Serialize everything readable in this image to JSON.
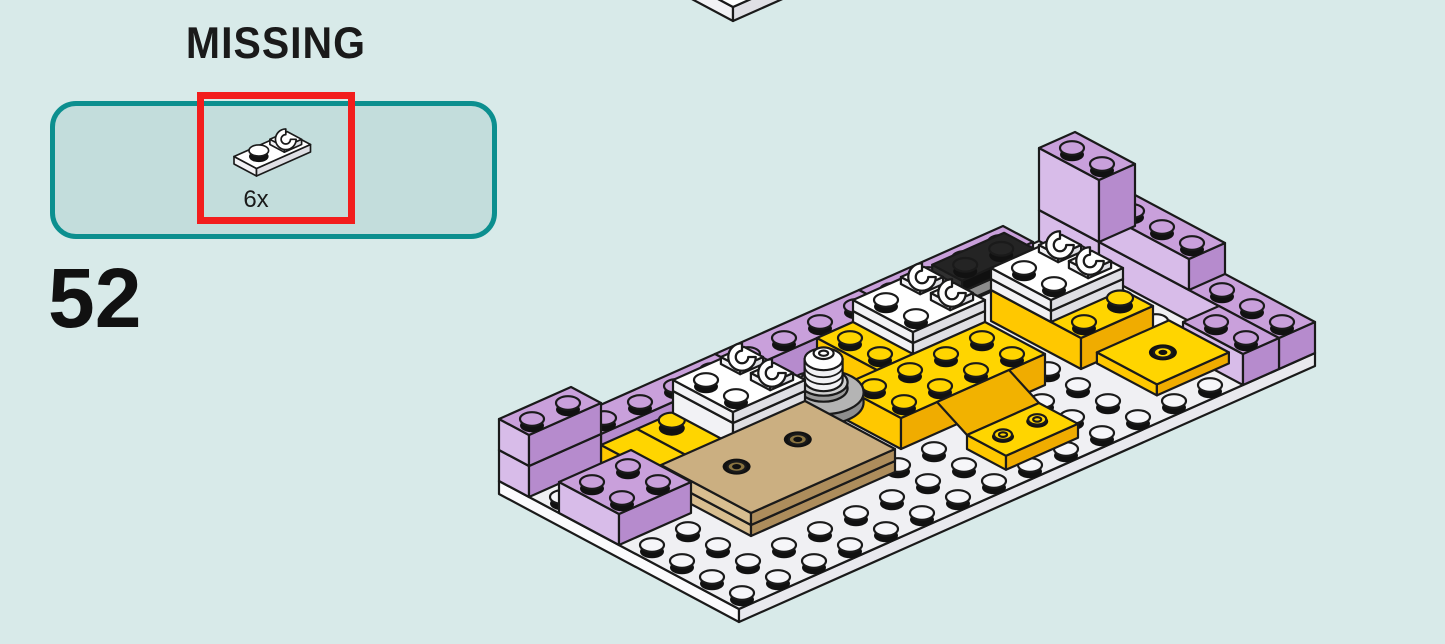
{
  "page": {
    "background": "#D8EAE9"
  },
  "missing_callout": {
    "title": "MISSING",
    "quantity_label": "6x",
    "part": "white 1x2 plate with open clip",
    "panel_color": "#C3DDDC",
    "panel_border_color": "#0C8F8F",
    "highlight_color": "#F21D1D"
  },
  "step": {
    "number": "52"
  },
  "illustration": {
    "description": "Isometric LEGO sub-assembly: white 8x16 baseplate edged with lavender bricks; three white clip-plate pairs on yellow/white stacks; yellow 2x4 brick, slope and inverted tray; yellow 2x2 tile with hole; tan 3x4 plate with two recessed holes; gray turntable with white round brick",
    "colors": {
      "outline": "#1A1A1A",
      "purple": [
        "#C9A0DB",
        "#D8BCE9",
        "#B68BCD"
      ],
      "yellow": [
        "#FFD500",
        "#FFC800",
        "#F0AC00"
      ],
      "white": [
        "#FFFFFF",
        "#F2F2F5",
        "#DFDFE4"
      ],
      "base": [
        "#F0F0F3",
        "#FBFBFD",
        "#E9E9EE"
      ],
      "tan": [
        "#CBAF81",
        "#D8BE90",
        "#AD8D5C"
      ],
      "grayd": [
        "#A6A6A6",
        "#B5B5B5",
        "#8C8C8C"
      ],
      "black": [
        "#242424",
        "#303030",
        "#101010"
      ],
      "gridstud": "#F6F6F9"
    },
    "scenes": [
      {
        "name": "partial-assembly",
        "ox": 745,
        "oy": -43,
        "s": 1,
        "pieces": [
          {
            "t": "box",
            "c": "purple",
            "x": 0,
            "y": 0,
            "w": 2,
            "d": 2,
            "z": 14,
            "h": 60,
            "st": 0
          },
          {
            "t": "box",
            "c": "white",
            "x": 0,
            "y": 0,
            "w": 2,
            "d": 2,
            "z": 0,
            "h": 14,
            "st": 0
          }
        ]
      },
      {
        "name": "main-assembly",
        "ox": 1075,
        "oy": 225,
        "s": 1,
        "pieces": [
          {
            "t": "box",
            "c": "base",
            "x": 0,
            "y": 0,
            "w": 8,
            "d": 16,
            "z": -13,
            "h": 13,
            "st": 0,
            "base": 1
          },
          {
            "t": "grid",
            "cols": 8,
            "rows": 16
          },
          {
            "t": "box",
            "c": "purple",
            "x": 0,
            "y": 0,
            "w": 2,
            "d": 1,
            "z": 0,
            "h": 31
          },
          {
            "t": "box",
            "c": "purple",
            "x": 2,
            "y": 0,
            "w": 6,
            "d": 1,
            "z": 0,
            "h": 31
          },
          {
            "t": "box",
            "c": "purple",
            "x": 2,
            "y": 0,
            "w": 3,
            "d": 1,
            "z": 31,
            "h": 31
          },
          {
            "t": "box",
            "c": "purple",
            "x": 0,
            "y": 0,
            "w": 2,
            "d": 1,
            "z": 31,
            "h": 62
          },
          {
            "t": "box",
            "c": "purple",
            "x": 6,
            "y": 1,
            "w": 2,
            "d": 1,
            "z": 0,
            "h": 31
          },
          {
            "t": "box",
            "c": "purple",
            "x": 0,
            "y": 2,
            "w": 1,
            "d": 4,
            "z": 0,
            "h": 31
          },
          {
            "t": "box",
            "c": "grayd",
            "x": 1,
            "y": 2.8,
            "w": 1,
            "d": 3,
            "z": 31,
            "h": 11
          },
          {
            "t": "box",
            "c": "black",
            "x": 1,
            "y": 2.8,
            "w": 1,
            "d": 2,
            "z": 42,
            "h": 11
          },
          {
            "t": "box",
            "c": "yellow",
            "x": 2,
            "y": 2,
            "w": 3,
            "d": 2,
            "z": 0,
            "h": 31
          },
          {
            "t": "box",
            "c": "white",
            "x": 2,
            "y": 2,
            "w": 2,
            "d": 2,
            "z": 31,
            "h": 11
          },
          {
            "t": "box",
            "c": "white",
            "x": 2,
            "y": 2,
            "w": 2,
            "d": 2,
            "z": 42,
            "h": 11
          },
          {
            "t": "round",
            "c": "yellow",
            "x": 4.5,
            "y": 2.5,
            "z": 31
          },
          {
            "t": "clip",
            "x": 2.5,
            "y": 2.5,
            "z": 53
          },
          {
            "t": "clip",
            "x": 3.5,
            "y": 2.5,
            "z": 53
          },
          {
            "t": "box",
            "c": "yellow",
            "x": 5.05,
            "y": 1.6,
            "w": 2,
            "d": 2,
            "z": 0,
            "h": 11,
            "st": 0
          },
          {
            "t": "hole",
            "c": "yellow",
            "x": 6.05,
            "y": 2.6,
            "z": 11
          },
          {
            "t": "box",
            "c": "purple",
            "x": 0,
            "y": 6,
            "w": 1,
            "d": 4,
            "z": 0,
            "h": 31
          },
          {
            "t": "box",
            "c": "yellow",
            "x": 1,
            "y": 5,
            "w": 2,
            "d": 3,
            "z": 0,
            "h": 31
          },
          {
            "t": "box",
            "c": "white",
            "x": 1,
            "y": 5,
            "w": 2,
            "d": 2,
            "z": 31,
            "h": 11
          },
          {
            "t": "box",
            "c": "white",
            "x": 1,
            "y": 5,
            "w": 2,
            "d": 2,
            "z": 42,
            "h": 11
          },
          {
            "t": "clip",
            "x": 1.5,
            "y": 5.5,
            "z": 53
          },
          {
            "t": "clip",
            "x": 2.5,
            "y": 5.5,
            "z": 53
          },
          {
            "t": "box",
            "c": "yellow",
            "x": 3,
            "y": 5,
            "w": 2,
            "d": 4,
            "z": 0,
            "h": 31
          },
          {
            "t": "quad",
            "f": "#F2B200",
            "pts": [
              [
                5,
                6,
                31
              ],
              [
                5,
                8,
                31
              ],
              [
                6,
                8,
                14
              ],
              [
                6,
                6,
                14
              ]
            ]
          },
          {
            "t": "cover",
            "x": 5,
            "y": 6,
            "w": 1,
            "d": 2
          },
          {
            "t": "box",
            "c": "yellow",
            "x": 6,
            "y": 6,
            "w": 1.3,
            "d": 2,
            "z": 0,
            "h": 14,
            "st": 0
          },
          {
            "t": "rstud",
            "x": 6.6,
            "y": 6.55,
            "z": 14
          },
          {
            "t": "rstud",
            "x": 6.6,
            "y": 7.5,
            "z": 14
          },
          {
            "t": "tt",
            "x": 2.3,
            "y": 8.9
          },
          {
            "t": "round",
            "c": "white",
            "x": 1.85,
            "y": 9.6,
            "z": 0
          },
          {
            "t": "round",
            "c": "white",
            "x": 1.85,
            "y": 9.6,
            "z": 9
          },
          {
            "t": "round",
            "c": "white",
            "x": 1.85,
            "y": 9.6,
            "z": 18
          },
          {
            "t": "box",
            "c": "purple",
            "x": 0,
            "y": 10,
            "w": 1,
            "d": 4,
            "z": 0,
            "h": 31
          },
          {
            "t": "box",
            "c": "yellow",
            "x": 1,
            "y": 10,
            "w": 2,
            "d": 3,
            "z": 0,
            "h": 20,
            "st": 0
          },
          {
            "t": "round",
            "c": "yellow",
            "x": 1.5,
            "y": 12.45,
            "z": 20
          },
          {
            "t": "box",
            "c": "white",
            "x": 1,
            "y": 10,
            "w": 2,
            "d": 2,
            "z": 20,
            "h": 22
          },
          {
            "t": "box",
            "c": "white",
            "x": 1,
            "y": 10,
            "w": 2,
            "d": 2,
            "z": 42,
            "h": 11
          },
          {
            "t": "clip",
            "x": 1.5,
            "y": 10.5,
            "z": 53
          },
          {
            "t": "clip",
            "x": 2.5,
            "y": 10.5,
            "z": 53
          },
          {
            "t": "box",
            "c": "yellow",
            "x": 1,
            "y": 13,
            "w": 2,
            "d": 1,
            "z": 0,
            "h": 20,
            "st": 0
          },
          {
            "t": "box",
            "c": "tan",
            "x": 3,
            "y": 10,
            "w": 3,
            "d": 4,
            "z": 9,
            "h": 11,
            "st": 0
          },
          {
            "t": "box",
            "c": "tan",
            "x": 3,
            "y": 10,
            "w": 3,
            "d": 4,
            "z": 20,
            "h": 12,
            "st": 0
          },
          {
            "t": "hole",
            "c": "tan",
            "x": 4.2,
            "y": 11.2,
            "z": 32
          },
          {
            "t": "hole",
            "c": "tan",
            "x": 4.2,
            "y": 12.9,
            "z": 32
          },
          {
            "t": "box",
            "c": "purple",
            "x": 0,
            "y": 14,
            "w": 1,
            "d": 2,
            "z": 0,
            "h": 31
          },
          {
            "t": "box",
            "c": "purple",
            "x": 0,
            "y": 14,
            "w": 1,
            "d": 2,
            "z": 31,
            "h": 31
          },
          {
            "t": "box",
            "c": "purple",
            "x": 2,
            "y": 14,
            "w": 2,
            "d": 2,
            "z": 0,
            "h": 31
          }
        ]
      },
      {
        "name": "missing-part-icon",
        "ox": 288,
        "oy": 140,
        "s": 0.75,
        "pieces": [
          {
            "t": "box",
            "c": "white",
            "x": 0,
            "y": 0,
            "w": 1,
            "d": 2,
            "z": 0,
            "h": 10,
            "st": 0
          },
          {
            "t": "round",
            "c": "white",
            "x": 0.5,
            "y": 1.5,
            "z": 10
          },
          {
            "t": "clip",
            "x": 0.5,
            "y": 0.5,
            "z": 10
          }
        ]
      }
    ]
  }
}
